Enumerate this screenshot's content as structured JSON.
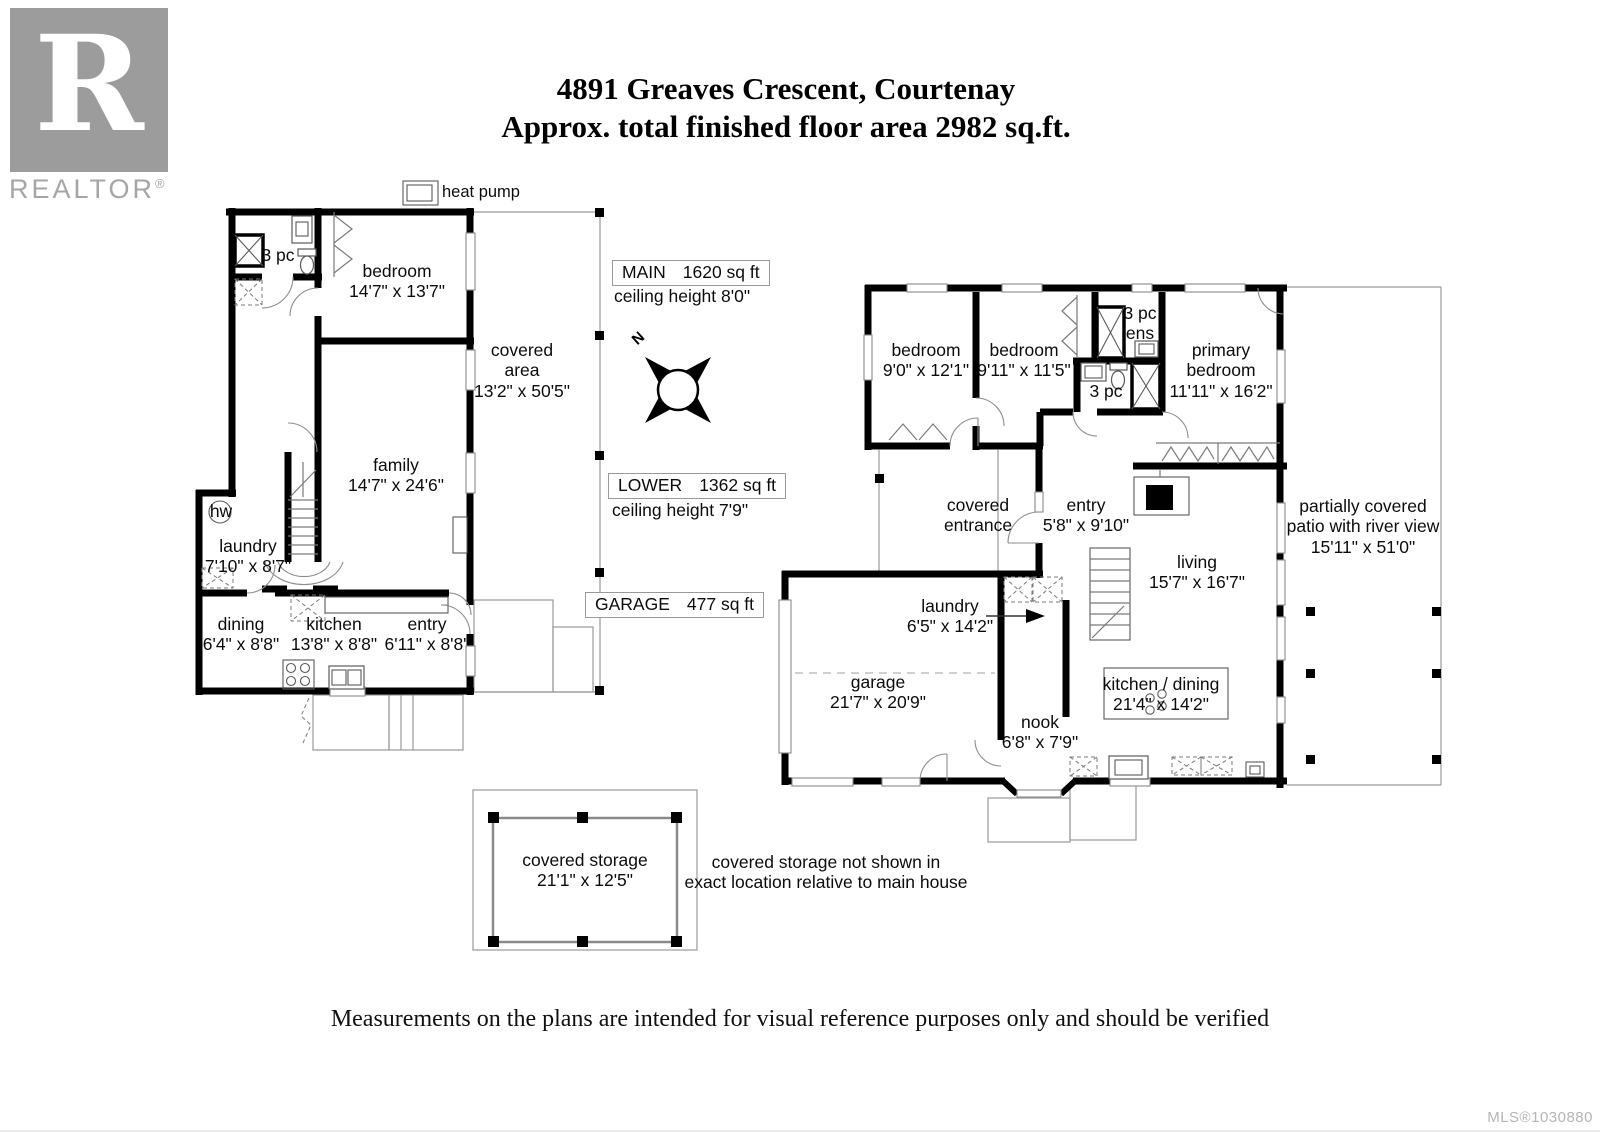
{
  "title": {
    "line1": "4891 Greaves Crescent, Courtenay",
    "line2": "Approx. total finished floor area 2982 sq.ft."
  },
  "branding": {
    "logo_letter": "R",
    "logo_word": "REALTOR",
    "registered": "®"
  },
  "misc": {
    "heat_pump": "heat pump"
  },
  "compass": {
    "north": "N"
  },
  "area_tags": {
    "main": {
      "name": "MAIN",
      "area": "1620 sq ft",
      "ceiling": "ceiling height 8'0\""
    },
    "lower": {
      "name": "LOWER",
      "area": "1362 sq ft",
      "ceiling": "ceiling height 7'9\""
    },
    "garage": {
      "name": "GARAGE",
      "area": "477 sq ft"
    }
  },
  "lower_floor": {
    "labels": [
      {
        "id": "bath-3pc",
        "lines": [
          "3 pc"
        ]
      },
      {
        "id": "bedroom",
        "lines": [
          "bedroom",
          "14'7\" x 13'7\""
        ]
      },
      {
        "id": "covered-area",
        "lines": [
          "covered",
          "area",
          "13'2\" x 50'5\""
        ]
      },
      {
        "id": "family",
        "lines": [
          "family",
          "14'7\" x 24'6\""
        ]
      },
      {
        "id": "hot-water",
        "lines": [
          "hw"
        ]
      },
      {
        "id": "laundry",
        "lines": [
          "laundry",
          "7'10\" x 8'7\""
        ]
      },
      {
        "id": "dining",
        "lines": [
          "dining",
          "6'4\" x 8'8\""
        ]
      },
      {
        "id": "kitchen",
        "lines": [
          "kitchen",
          "13'8\" x 8'8\""
        ]
      },
      {
        "id": "entry",
        "lines": [
          "entry",
          "6'11\" x 8'8\""
        ]
      }
    ]
  },
  "main_floor": {
    "labels": [
      {
        "id": "bedroom-1",
        "lines": [
          "bedroom",
          "9'0\" x 12'1\""
        ]
      },
      {
        "id": "bedroom-2",
        "lines": [
          "bedroom",
          "9'11\" x 11'5\""
        ]
      },
      {
        "id": "ensuite",
        "lines": [
          "3 pc",
          "ens"
        ]
      },
      {
        "id": "bathroom",
        "lines": [
          "3 pc"
        ]
      },
      {
        "id": "primary-bedroom",
        "lines": [
          "primary",
          "bedroom",
          "11'11\" x 16'2\""
        ]
      },
      {
        "id": "covered-entrance",
        "lines": [
          "covered",
          "entrance"
        ]
      },
      {
        "id": "entry",
        "lines": [
          "entry",
          "5'8\" x 9'10\""
        ]
      },
      {
        "id": "living",
        "lines": [
          "living",
          "15'7\" x 16'7\""
        ]
      },
      {
        "id": "patio",
        "lines": [
          "partially covered",
          "patio with river view",
          "15'11\" x 51'0\""
        ]
      },
      {
        "id": "laundry",
        "lines": [
          "laundry",
          "6'5\" x 14'2\""
        ]
      },
      {
        "id": "garage",
        "lines": [
          "garage",
          "21'7\" x 20'9\""
        ]
      },
      {
        "id": "nook",
        "lines": [
          "nook",
          "6'8\" x 7'9\""
        ]
      },
      {
        "id": "kitchen-dining",
        "lines": [
          "kitchen / dining",
          "21'4\" x 14'2\""
        ]
      }
    ]
  },
  "storage": {
    "label": {
      "lines": [
        "covered storage",
        "21'1\" x 12'5\""
      ]
    },
    "note": {
      "lines": [
        "covered storage not shown in",
        "exact location relative to main house"
      ]
    }
  },
  "footer": {
    "disclaimer": "Measurements on the plans are intended for visual reference purposes only and should be verified",
    "mls": "MLS®1030880"
  }
}
